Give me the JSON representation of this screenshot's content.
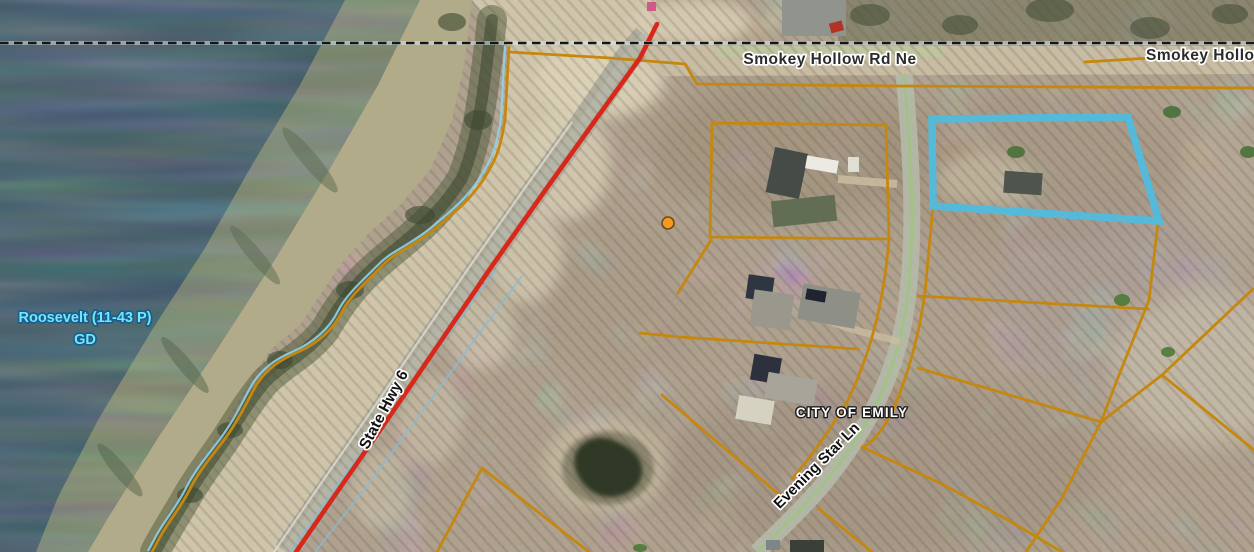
{
  "map": {
    "labels": {
      "road_main": "Smokey Hollow Rd Ne",
      "road_main_continued": "Smokey Hollow",
      "lake_name": "Roosevelt (11-43 P)",
      "lake_designation": "GD",
      "highway": "State Hwy 6",
      "city": "CITY OF EMILY",
      "street": "Evening Star Ln"
    },
    "colors": {
      "parcel_line": "#C6870F",
      "selected_parcel_outline": "#55B9DA",
      "highway_line": "#D7281A",
      "city_boundary_dash": "#151515",
      "shoreline_line": "#8FD2EA",
      "road_centerline": "#9CC47E",
      "marker_fill": "#F49A1E",
      "water": "#3A5765",
      "lake_label_fill": "#70E9F7",
      "road_label_fill": "#2B2B2B",
      "street_label_fill": "#111111",
      "city_label_fill": "#FFFFFF"
    }
  }
}
